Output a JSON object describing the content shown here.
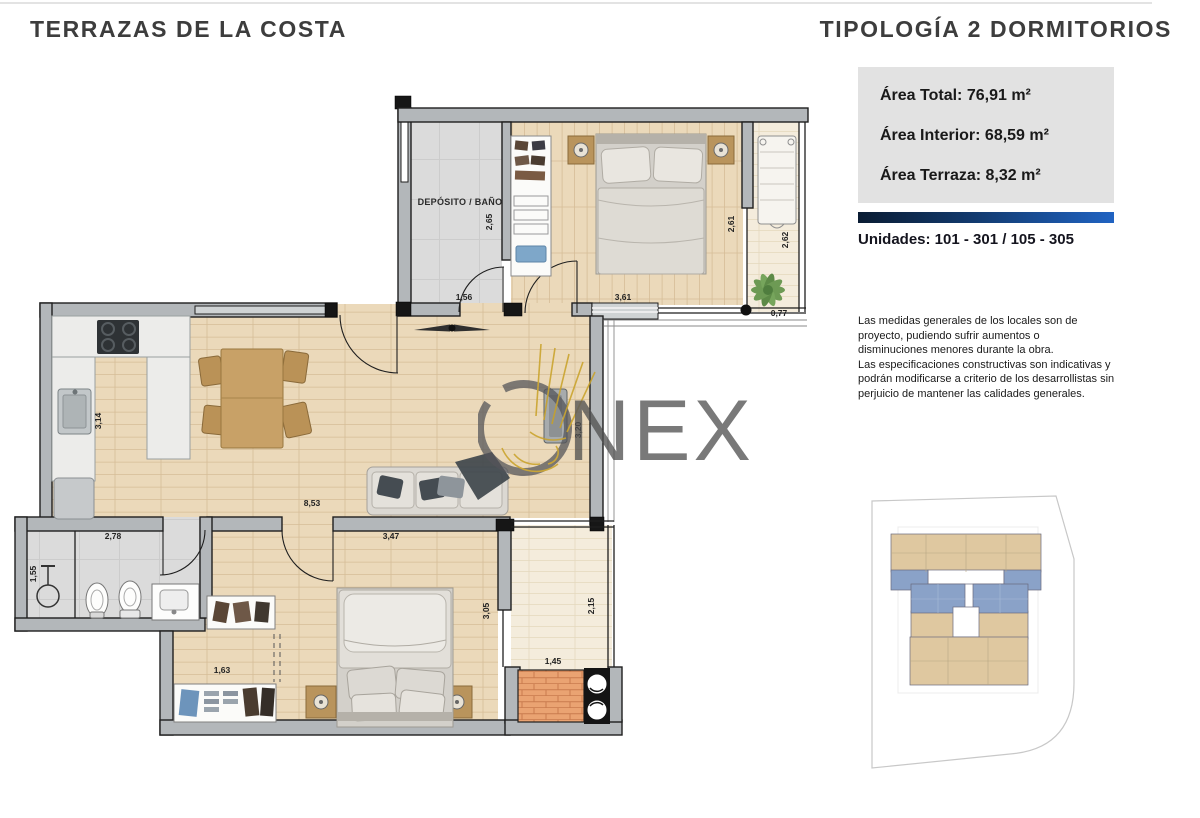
{
  "page": {
    "project_title": "TERRAZAS DE LA COSTA",
    "typology_title": "TIPOLOGÍA 2 DORMITORIOS"
  },
  "info_panel": {
    "area_lines": [
      "Área Total: 76,91 m²",
      "Área Interior: 68,59 m²",
      "Área Terraza: 8,32 m²"
    ],
    "units_line": "Unidades: 101 - 301 / 105 - 305",
    "disclaimer": "Las medidas generales de los locales son de\nproyecto, pudiendo sufrir aumentos o\ndisminuciones menores durante la obra.\nLas especificaciones constructivas son indicativas y\npodrán modificarse a criterio de los desarrollistas sin\nperjuicio de mantener las calidades generales."
  },
  "floorplan": {
    "room_label": "DEPÓSITO / BAÑO",
    "dims": [
      "2,65",
      "1,56",
      "3,61",
      "2,61",
      "2,62",
      "0,77",
      "3,14",
      "8,53",
      "3,20",
      "2,78",
      "1,55",
      "3,47",
      "1,63",
      "3,05",
      "2,15",
      "1,45"
    ]
  },
  "watermark": {
    "text": "NEX"
  },
  "colors": {
    "bar_gradient_start": "#0a1c33",
    "bar_gradient_end": "#2063c2",
    "area_box_bg": "#e2e2e2",
    "keyplan_highlight": "#8aa2c8",
    "keyplan_units": "#dfc8a0",
    "watermark_gold": "#c9a227",
    "wood_floor": "#ebd9ba",
    "terrace_floor": "#f4ecdc",
    "brick": "#eaa372"
  }
}
